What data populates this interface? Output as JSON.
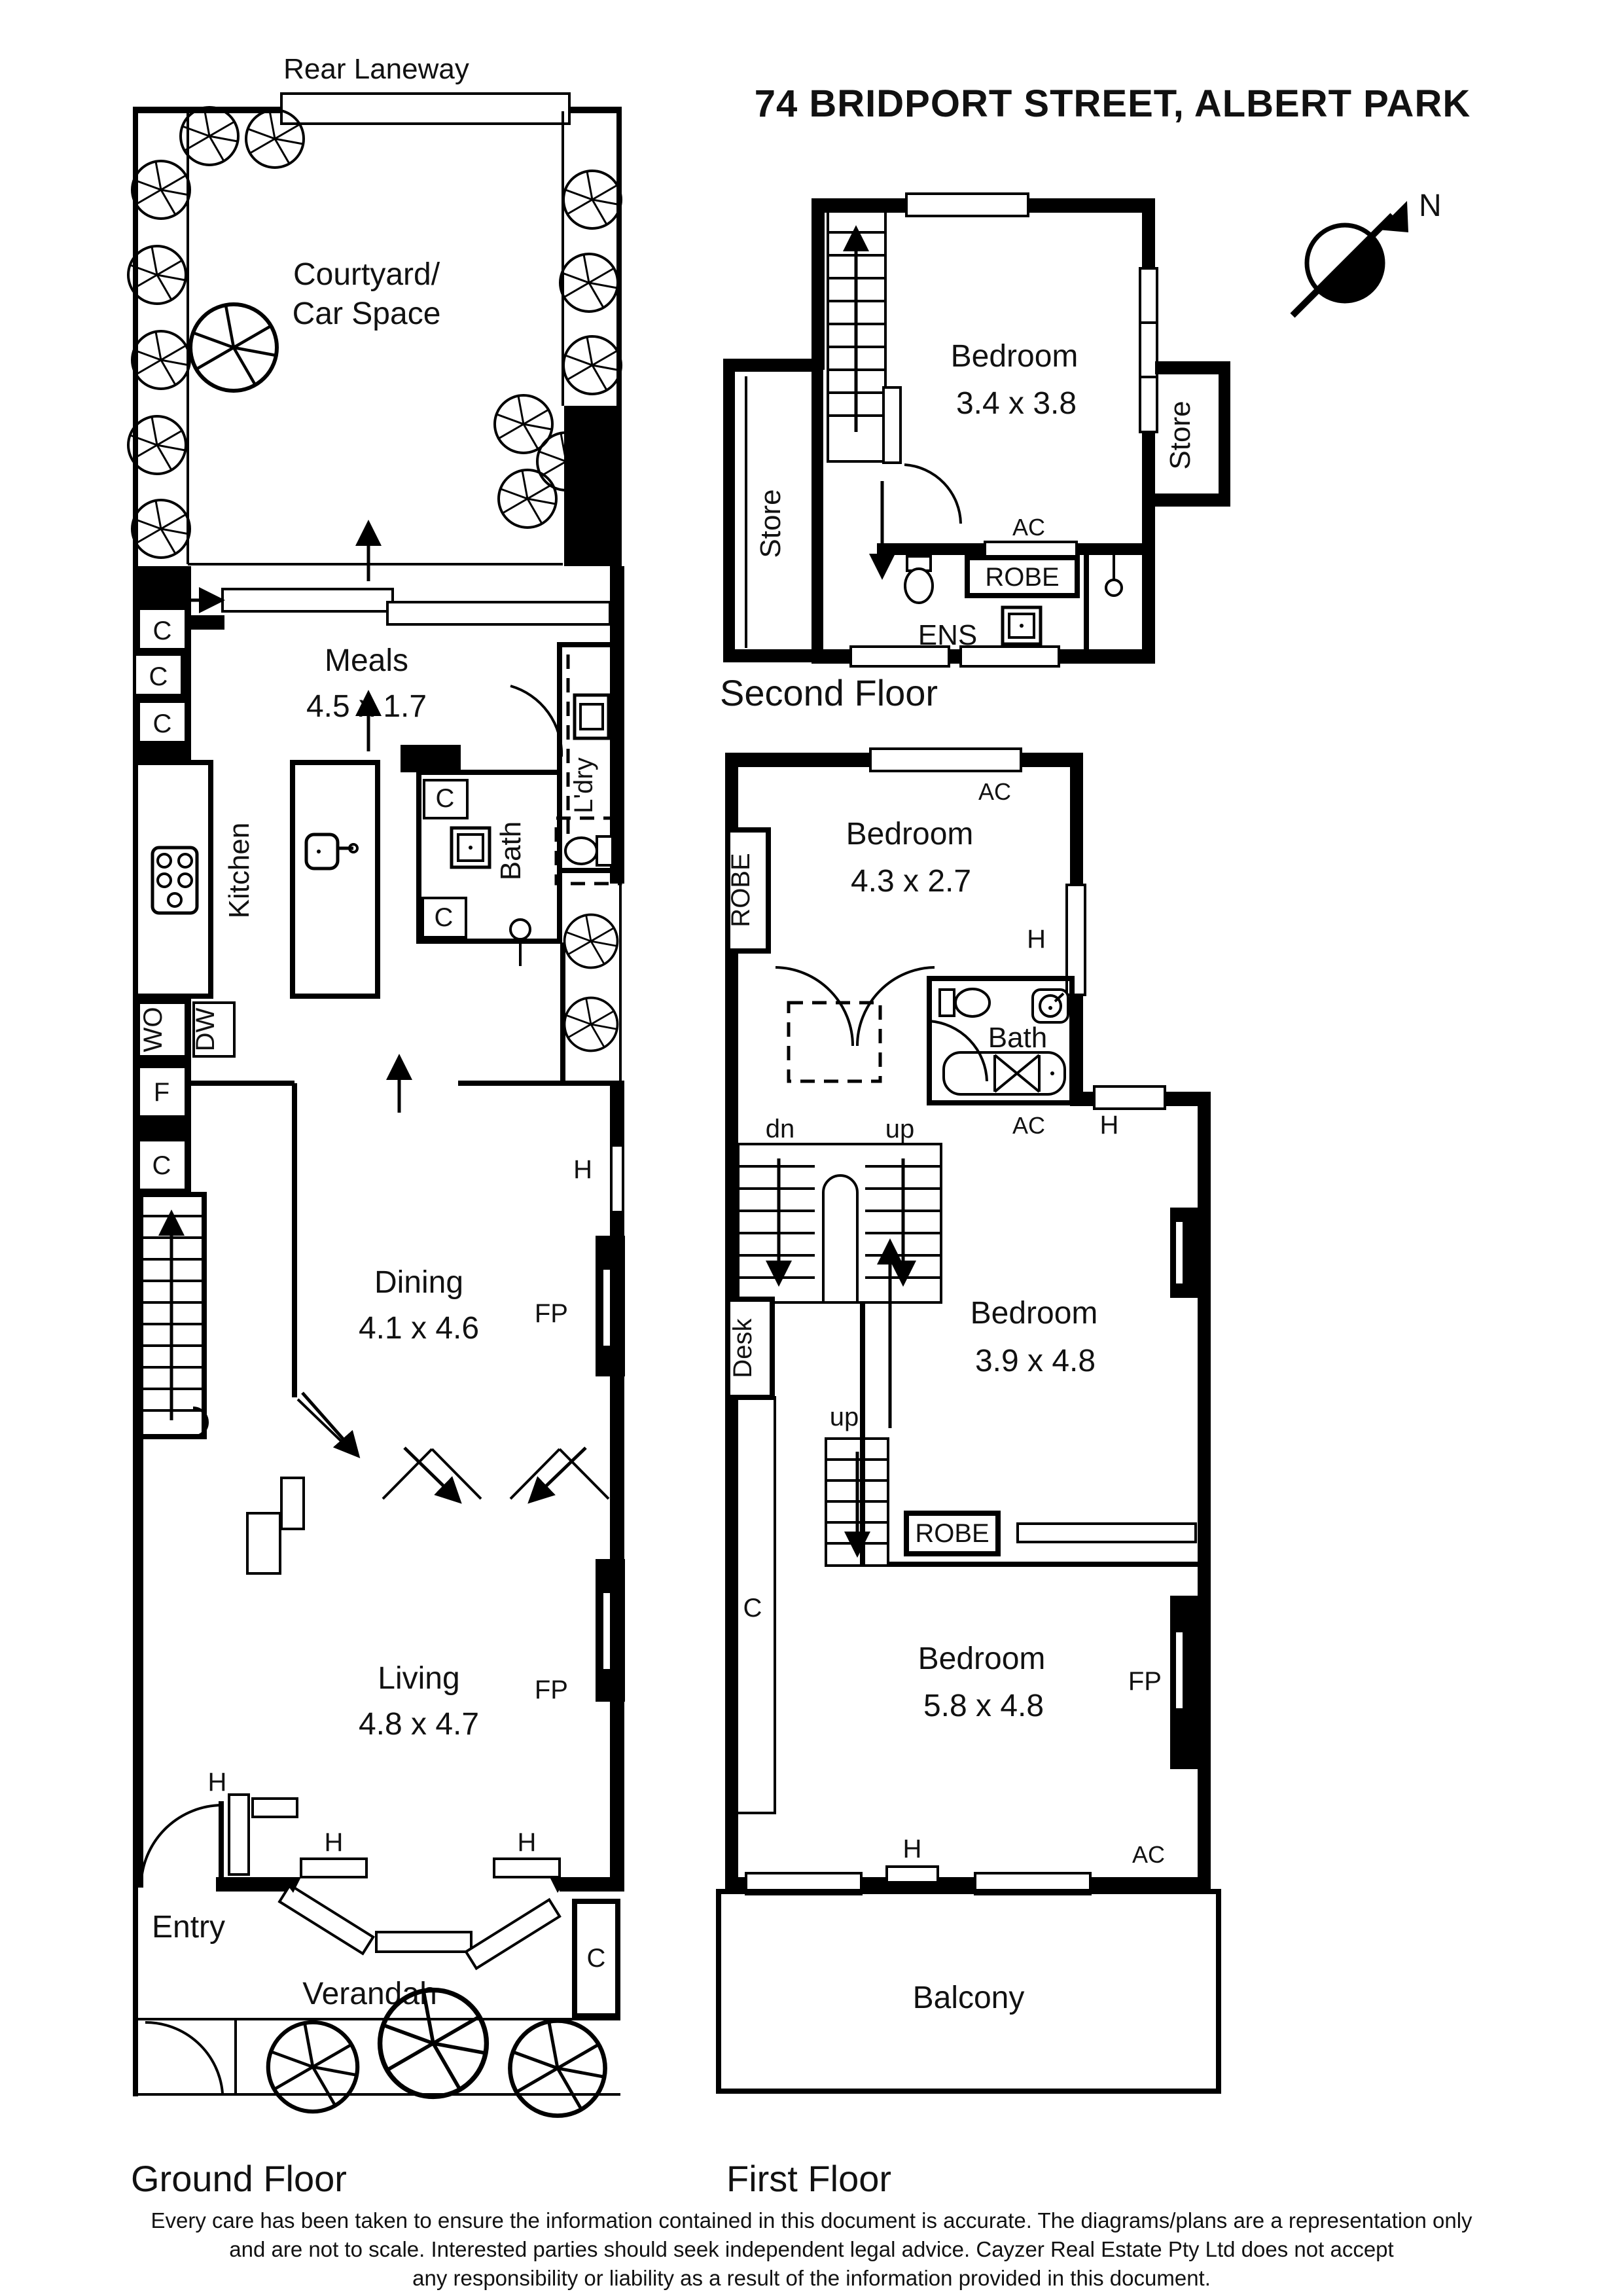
{
  "title": "74 BRIDPORT STREET, ALBERT PARK",
  "compass": {
    "north": "N"
  },
  "shared": {
    "c": "C",
    "h": "H",
    "fp": "FP",
    "ac": "AC",
    "robe": "ROBE",
    "store": "Store",
    "bedroom": "Bedroom",
    "up": "up",
    "dn": "dn",
    "bath": "Bath"
  },
  "ground": {
    "caption": "Ground Floor",
    "laneway": "Rear Laneway",
    "courtyard_line1": "Courtyard/",
    "courtyard_line2": "Car Space",
    "meals": "Meals",
    "meals_dims": "4.5 x 1.7",
    "kitchen": "Kitchen",
    "laundry": "L'dry",
    "wall_oven": "WO",
    "dishwasher": "DW",
    "fridge": "F",
    "dining": "Dining",
    "dining_dims": "4.1 x 4.6",
    "living": "Living",
    "living_dims": "4.8 x 4.7",
    "entry": "Entry",
    "verandah": "Verandah"
  },
  "second": {
    "caption": "Second Floor",
    "bedroom_dims": "3.4 x 3.8",
    "ens": "ENS"
  },
  "first": {
    "caption": "First Floor",
    "bedroom1_dims": "4.3 x 2.7",
    "bedroom2_dims": "3.9 x 4.8",
    "bedroom3_dims": "5.8 x 4.8",
    "desk": "Desk",
    "balcony": "Balcony"
  },
  "disclaimer": {
    "line1": "Every care has been taken to ensure the information contained in this document is accurate. The diagrams/plans are a representation only",
    "line2": "and are not to scale. Interested parties should seek independent legal advice. Cayzer Real Estate Pty Ltd does not accept",
    "line3": "any responsibility or liability as a result of the information provided in this document."
  }
}
